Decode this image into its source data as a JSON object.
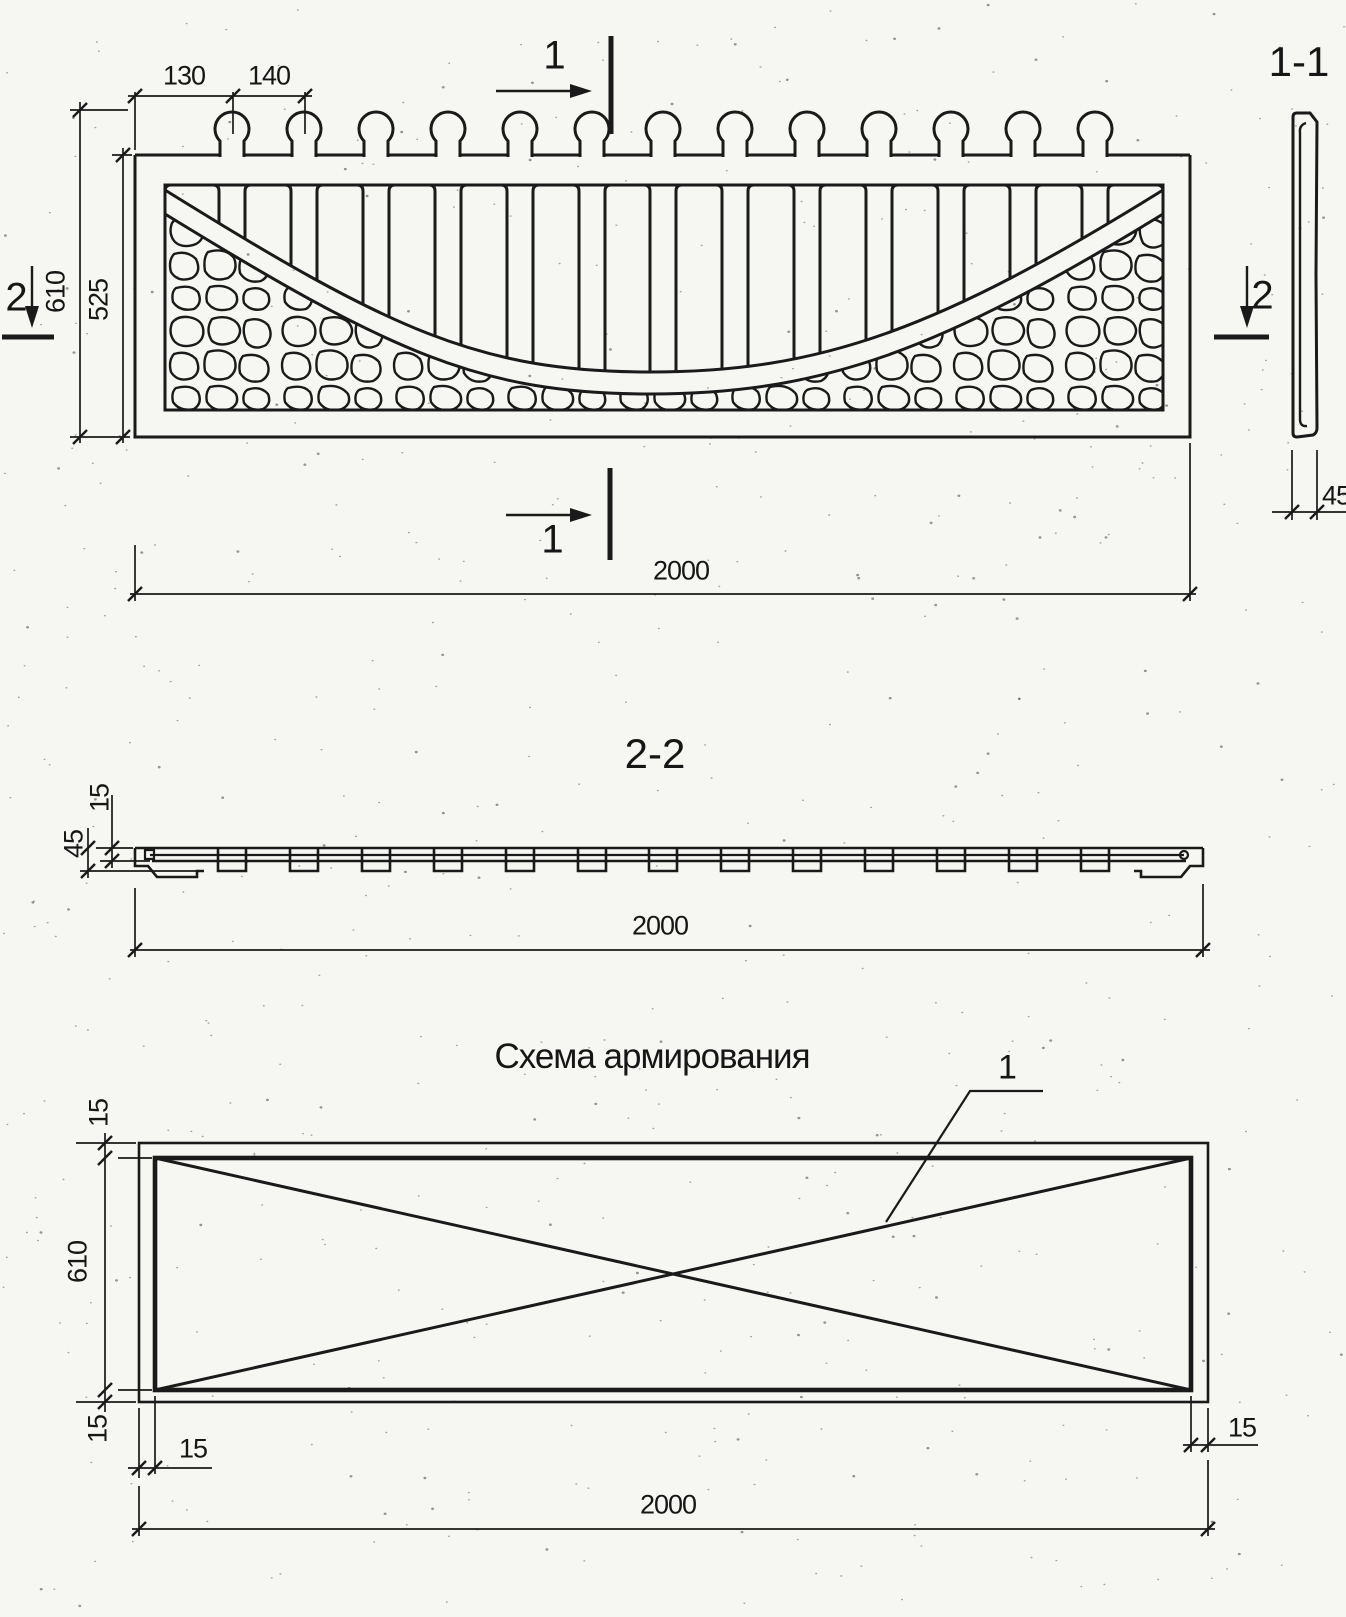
{
  "colors": {
    "ink": "#1a1a1a",
    "paper": "#f6f6f3"
  },
  "front_view": {
    "dim_130": "130",
    "dim_140": "140",
    "dim_610": "610",
    "dim_525": "525",
    "dim_2000": "2000",
    "cut_1_top": "1",
    "cut_1_bottom": "1",
    "cut_2_left": "2",
    "cut_2_right": "2"
  },
  "section_1_1": {
    "title": "1-1",
    "dim_45": "45"
  },
  "section_2_2": {
    "title": "2-2",
    "dim_15": "15",
    "dim_45": "45",
    "dim_2000": "2000"
  },
  "reinforcement_scheme": {
    "title": "Схема армирования",
    "rebar_callout": "1",
    "dim_15_top": "15",
    "dim_610": "610",
    "dim_15_bottom": "15",
    "dim_15_left": "15",
    "dim_15_right": "15",
    "dim_2000": "2000"
  }
}
